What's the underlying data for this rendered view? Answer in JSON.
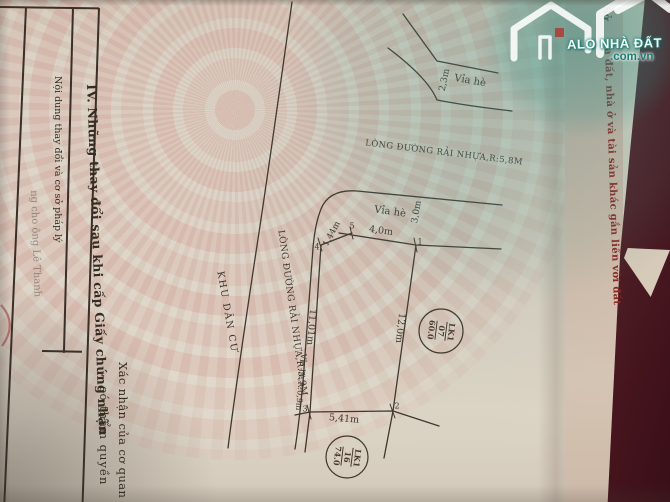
{
  "watermark": {
    "brand_name": "ALO NHÀ ĐẤT",
    "brand_domain": ".com.vn"
  },
  "page_left": {
    "section_title": "IV. Những thay đổi sau khi cấp Giấy chứng nhận",
    "col_content": "Nội dung thay đổi và cơ sở pháp lý",
    "col_confirm_line1": "Xác nhận của cơ quan",
    "col_confirm_line2": "có thẩm quyền",
    "bleed_note": "ng cho ông Lê Thanh"
  },
  "page_right_edge": {
    "fragment_dark": "Sở",
    "title_fragment": "a đất, nhà ở và tài sản khác gắn liền với đất"
  },
  "diagram": {
    "road_top": "LÒNG ĐƯỜNG RẢI NHỰA,R:5,8M",
    "road_west": "LÒNG ĐƯỜNG RẢI NHỰA,R:3,9M",
    "zone": "KHU DÂN CƯ",
    "sidewalk_top_label": "Vỉa hè",
    "sidewalk_top_width": "2,3m",
    "sidewalk_inner_label": "Vỉa hè",
    "sidewalk_inner_width": "3,0m",
    "sidewalk_west": "Vỉa hè,R:0,9m",
    "dims": {
      "top": "4,0m",
      "right": "12,0m",
      "west": "11,01m",
      "bottom": "5,41m",
      "chamfer": "1,44m"
    },
    "corners": {
      "c1": "1",
      "c2": "2",
      "c3": "3",
      "c4": "4",
      "c5": "5"
    },
    "parcel_main": {
      "block": "LK1",
      "lot": "07",
      "area": "60.0"
    },
    "parcel_below": {
      "block": "LK1",
      "lot": "16",
      "area": "74.0"
    }
  },
  "colors": {
    "watermark_teal": "#2f8e83",
    "title_red": "#8e2420",
    "cover_maroon": "#4a1a22",
    "ink": "#3e352c"
  }
}
